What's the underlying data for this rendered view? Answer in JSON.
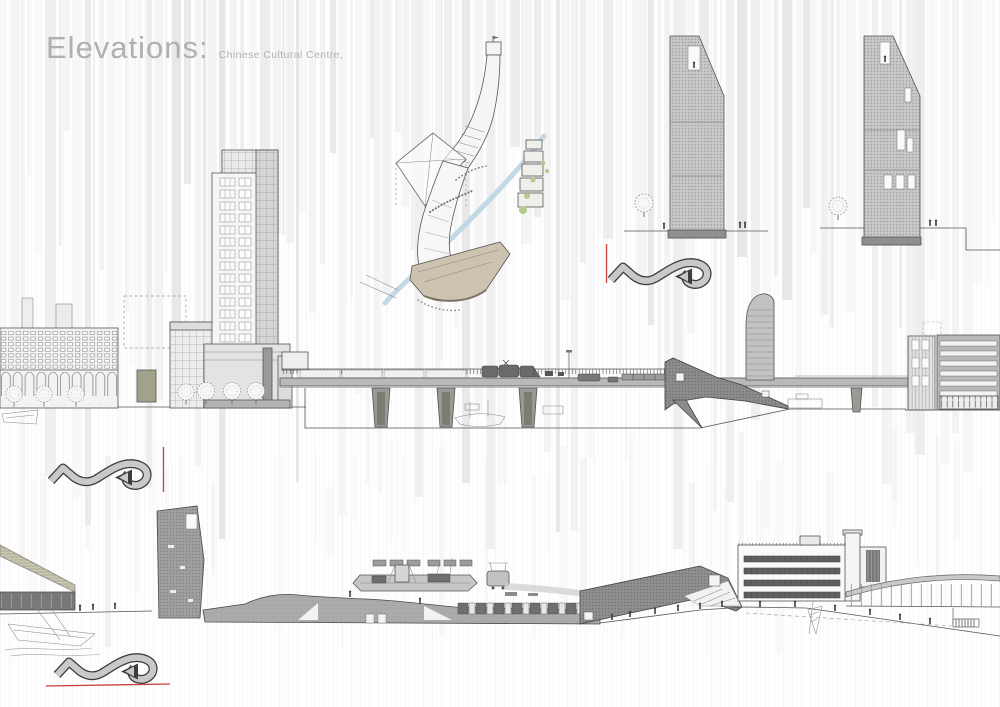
{
  "title": {
    "main": "Elevations:",
    "subtitle": "Chinese Cultural Centre,"
  },
  "palette": {
    "title_gray": "#b0b0b0",
    "line": "#555555",
    "line_dark": "#3d3d3d",
    "fill_light": "#eaeaea",
    "fill_mid": "#c9c9c9",
    "fill_dark": "#8c8c8c",
    "accent_red": "#c74040",
    "river_blue": "#bdd6e3",
    "hull_beige": "#ccc2af",
    "olive_block": "#a2a28c",
    "foliage_green": "#b5c98e"
  },
  "figures": [
    {
      "name": "axonometric-concept-sketch"
    },
    {
      "name": "tower-elevation-left"
    },
    {
      "name": "tower-elevation-right"
    },
    {
      "name": "street-elevation-upper"
    },
    {
      "name": "street-elevation-lower"
    }
  ],
  "annotations": {
    "arrow_icon": "curved-ribbon-arrow-right",
    "red_vertical_markers": 2,
    "red_horizontal_markers": 1
  }
}
